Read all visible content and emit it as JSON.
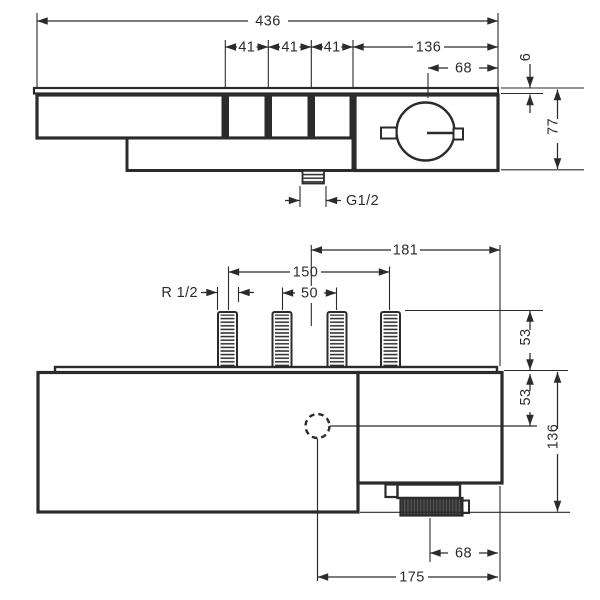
{
  "drawing": {
    "kind": "technical dimension drawing",
    "subject": "shower thermostat valve, two orthographic views",
    "units": "mm",
    "line_color": "#2b2b2b",
    "background_color": "#ffffff"
  },
  "labels": {
    "top": {
      "overall_width": "436",
      "button_spacing_1": "41",
      "button_spacing_2": "41",
      "button_spacing_3": "41",
      "right_section_width": "136",
      "knob_center_offset": "68",
      "plate_thickness": "6",
      "body_height": "77",
      "outlet_thread": "G1/2"
    },
    "bottom": {
      "center_to_edge": "181",
      "outer_pipe_spacing": "150",
      "inner_pipe_spacing": "50",
      "pipe_thread": "R 1/2",
      "pipe_length": "53",
      "center_depth": "53",
      "overall_depth": "136",
      "outlet_offset": "68",
      "outlet_center_to_edge": "175"
    }
  }
}
